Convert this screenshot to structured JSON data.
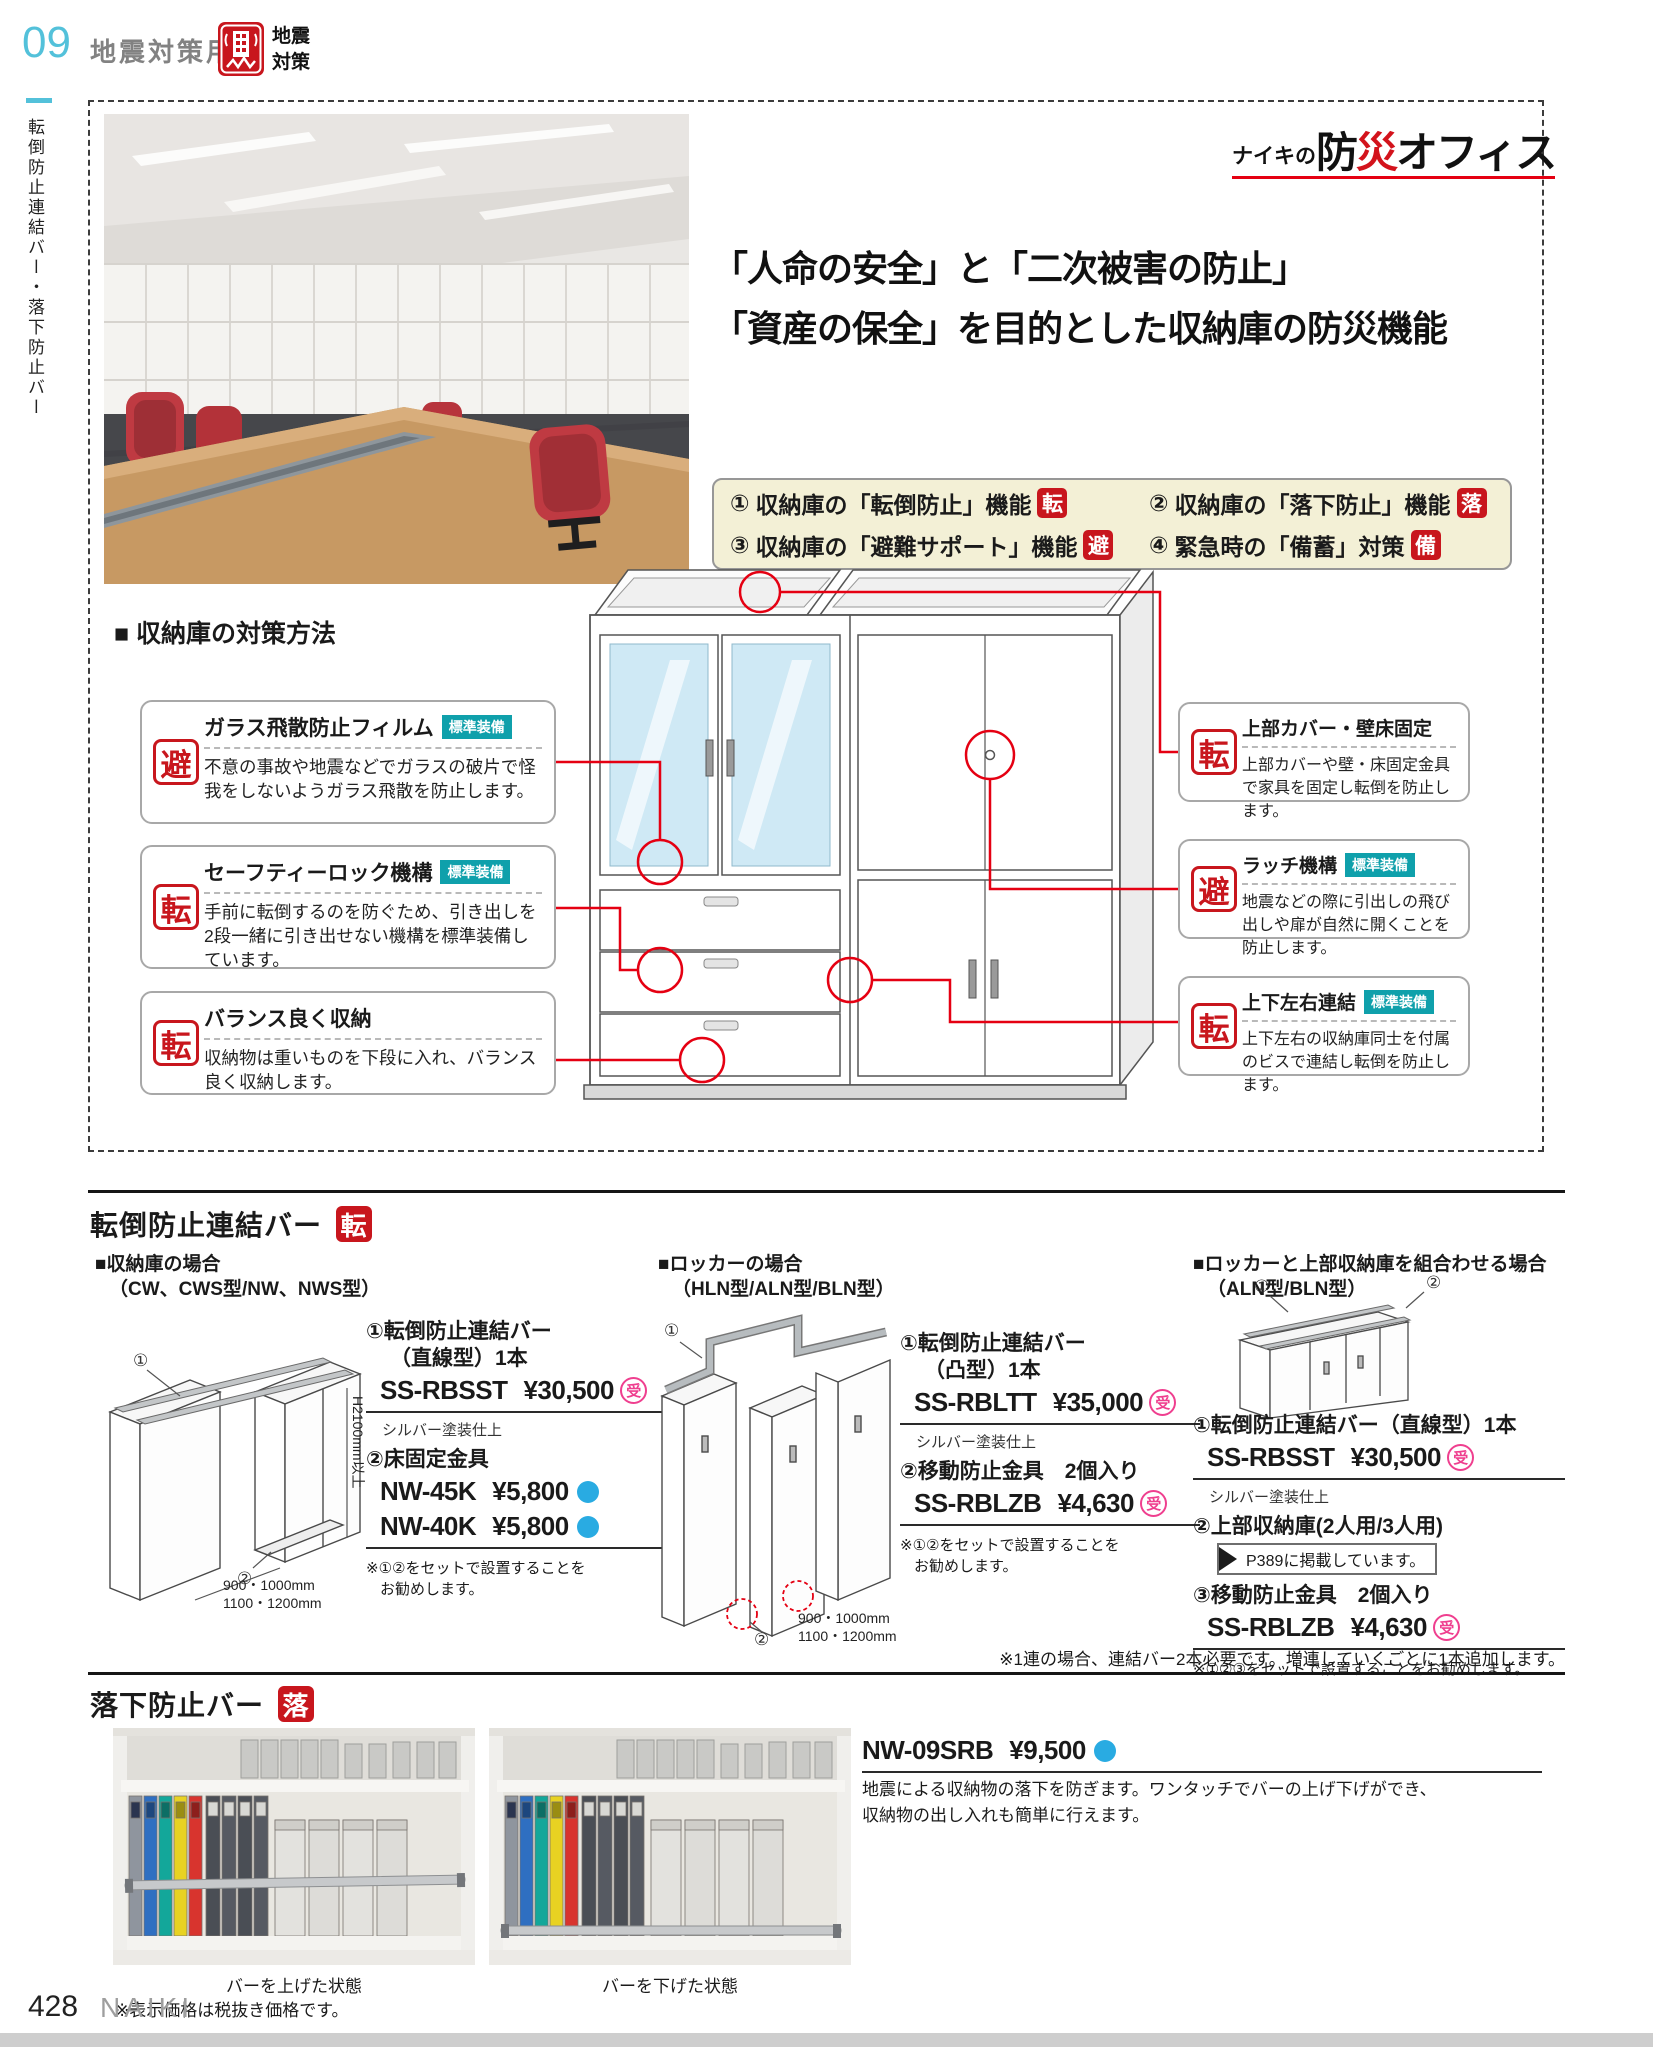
{
  "colors": {
    "accent_red": "#c8161d",
    "teal_badge": "#0fa0ab",
    "price_mark_pink": "#ef3f8f",
    "dot_blue": "#29abe2",
    "header_blue": "#53c1da",
    "connector_red": "#e50012"
  },
  "header": {
    "number": "09",
    "title": "地震対策用品",
    "badge_line1": "地震",
    "badge_line2": "対策"
  },
  "sidebar": {
    "vertical_label": "転倒防止連結バー・落下防止バー"
  },
  "hero": {
    "logo_prefix": "ナイキの",
    "logo_bold1": "防",
    "logo_red": "災",
    "logo_bold2": "オフィス",
    "headline1": "「人命の安全」と「二次被害の防止」",
    "headline2": "「資産の保全」を目的とした収納庫の防災機能",
    "features": [
      {
        "num": "①",
        "label": "収納庫の「転倒防止」機能",
        "stamp": "転"
      },
      {
        "num": "②",
        "label": "収納庫の「落下防止」機能",
        "stamp": "落"
      },
      {
        "num": "③",
        "label": "収納庫の「避難サポート」機能",
        "stamp": "避"
      },
      {
        "num": "④",
        "label": "緊急時の「備蓄」対策",
        "stamp": "備"
      }
    ]
  },
  "measures": {
    "heading": "■ 収納庫の対策方法",
    "left": [
      {
        "stamp": "避",
        "title": "ガラス飛散防止フィルム",
        "badge": "標準装備",
        "body": "不意の事故や地震などでガラスの破片で怪我をしないようガラス飛散を防止します。"
      },
      {
        "stamp": "転",
        "title": "セーフティーロック機構",
        "badge": "標準装備",
        "body": "手前に転倒するのを防ぐため、引き出しを2段一緒に引き出せない機構を標準装備しています。"
      },
      {
        "stamp": "転",
        "title": "バランス良く収納",
        "body": "収納物は重いものを下段に入れ、バランス良く収納します。"
      }
    ],
    "right": [
      {
        "stamp": "転",
        "title": "上部カバー・壁床固定",
        "body": "上部カバーや壁・床固定金具で家具を固定し転倒を防止します。"
      },
      {
        "stamp": "避",
        "title": "ラッチ機構",
        "badge": "標準装備",
        "body": "地震などの際に引出しの飛び出しや扉が自然に開くことを防止します。"
      },
      {
        "stamp": "転",
        "title": "上下左右連結",
        "badge": "標準装備",
        "body": "上下左右の収納庫同士を付属のビスで連結し転倒を防止します。"
      }
    ]
  },
  "bar_section": {
    "title": "転倒防止連結バー",
    "stamp": "転",
    "col1": {
      "case1": "■収納庫の場合",
      "case2": "（CW、CWS型/NW、NWS型）",
      "item1a": "①転倒防止連結バー",
      "item1b": "（直線型）1本",
      "code1": "SS-RBSST",
      "price1": "¥30,500",
      "mark1": "受",
      "finish": "シルバー塗装仕上",
      "item2": "②床固定金具",
      "code2a": "NW-45K",
      "price2a": "¥5,800",
      "code2b": "NW-40K",
      "price2b": "¥5,800",
      "note1": "※①②をセットで設置することを",
      "note2": "お勧めします。",
      "dim_h": "H2100mm以上",
      "dim_w1": "900・1000mm",
      "dim_w2": "1100・1200mm",
      "lbl1": "①",
      "lbl2": "②"
    },
    "col2": {
      "case1": "■ロッカーの場合",
      "case2": "（HLN型/ALN型/BLN型）",
      "item1a": "①転倒防止連結バー",
      "item1b": "（凸型）1本",
      "code1": "SS-RBLTT",
      "price1": "¥35,000",
      "mark1": "受",
      "finish": "シルバー塗装仕上",
      "item2": "②移動防止金具　2個入り",
      "code2": "SS-RBLZB",
      "price2": "¥4,630",
      "mark2": "受",
      "note1": "※①②をセットで設置することを",
      "note2": "お勧めします。",
      "dim_w1": "900・1000mm",
      "dim_w2": "1100・1200mm",
      "lbl1": "①",
      "lbl2": "②"
    },
    "col3": {
      "case1": "■ロッカーと上部収納庫を組合わせる場合",
      "case2": "（ALN型/BLN型）",
      "item1": "①転倒防止連結バー（直線型）1本",
      "code1": "SS-RBSST",
      "price1": "¥30,500",
      "mark1": "受",
      "finish": "シルバー塗装仕上",
      "item2": "②上部収納庫(2人用/3人用)",
      "ref": "P389に掲載しています。",
      "item3": "③移動防止金具　2個入り",
      "code3": "SS-RBLZB",
      "price3": "¥4,630",
      "mark3": "受",
      "note": "※①②③をセットで設置することをお勧めします。",
      "lbl1": "①",
      "lbl2": "②"
    },
    "footnote": "※1連の場合、連結バー2本必要です。増連していくごとに1本追加します。"
  },
  "drop_section": {
    "title": "落下防止バー",
    "stamp": "落",
    "code": "NW-09SRB",
    "price": "¥9,500",
    "desc1": "地震による収納物の落下を防ぎます。ワンタッチでバーの上げ下げができ、",
    "desc2": "収納物の出し入れも簡単に行えます。",
    "caption1": "バーを上げた状態",
    "caption2": "バーを下げた状態"
  },
  "footer": {
    "tax_note": "※表示価格は税抜き価格です。",
    "page_number": "428",
    "brand": "NAIKI"
  }
}
